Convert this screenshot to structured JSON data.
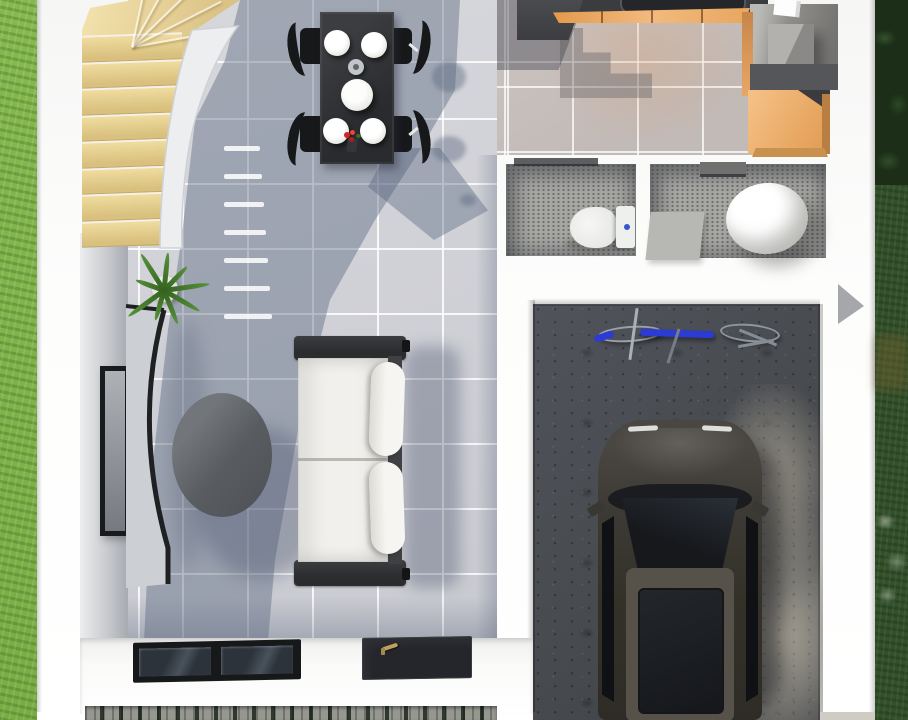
{
  "scene": {
    "title": "3D rendered top-down floor plan of a two-storey house ground floor",
    "rooms": [
      {
        "name": "staircase",
        "feature": "curved wooden stairs with white curved wall"
      },
      {
        "name": "dining-area",
        "feature": "black table, four plates, centre bowl, four black chairs"
      },
      {
        "name": "kitchen",
        "feature": "dark counters, orange cabinet fronts, island, appliance"
      },
      {
        "name": "bathroom-left",
        "feature": "toilet with blue flush button"
      },
      {
        "name": "bathroom-right",
        "feature": "round white tub and grey mat"
      },
      {
        "name": "garage",
        "feature": "concrete floor, parked car, bicycle"
      },
      {
        "name": "living-room",
        "feature": "white sofa, oval coffee table, curved TV console, plant, wall TV"
      },
      {
        "name": "entry",
        "feature": "front door with gold handle, double window, paving stones"
      }
    ],
    "furniture": [
      "stairs",
      "dining-table",
      "dining-chairs",
      "plates",
      "serving-bowl",
      "flower-vase",
      "stove",
      "kitchen-island",
      "appliance",
      "toilet",
      "tub",
      "bath-mat",
      "bicycle",
      "car",
      "sofa",
      "coffee-table",
      "tv",
      "tv-console",
      "plant",
      "front-door",
      "window",
      "paving-stones"
    ],
    "counts": {
      "stair_treads": 8,
      "stair_fan_lines": 5,
      "shadow_dashes": 7,
      "plant_leaves": 9,
      "dining_plates": 4,
      "dining_chairs": 4
    },
    "colors": {
      "grass_left": "#86b84e",
      "grass_left_2": "#79ad43",
      "grass_right": "#33502b",
      "trees_dark": "#1c2e18",
      "tile_light": "#d7d8dc",
      "tile_warm": "#ccc4c1",
      "shadow_blue": "rgba(86,99,124,0.42)",
      "stair_wood_light": "#f3e3ad",
      "stair_wood_dark": "#d0b878",
      "counter_dark": "#3b3c40",
      "cabinet_orange": "#e8a75f",
      "island_orange": "#f6c288",
      "appliance_gray": "#908f8c",
      "bath_floor": "#a6a6a3",
      "fixture_white": "#f6f6f3",
      "accent_blue": "#3558c8",
      "concrete_dark": "#46494d",
      "concrete_light": "#a8a399",
      "car_body": "#3d3a35",
      "car_roof": "#56524a",
      "car_glass": "#16181c",
      "sofa_frame": "#2b2c2e",
      "sofa_cushion": "#f1f0ec",
      "table_dark": "#2a2b2e",
      "table_oval": "#505357",
      "console_top": "#ccd0d4",
      "console_dark": "#1f2022",
      "chair_dark": "#17181a",
      "plant_green": "#57923a",
      "tv_frame": "#1a1b1d",
      "bike_blue": "#2b3bd4",
      "door_dark": "#24262b",
      "handle_gold": "#bfa05e",
      "frame_dark": "#17181a",
      "stone_gray": "#95988f",
      "stone_gap": "#2f3830"
    }
  }
}
